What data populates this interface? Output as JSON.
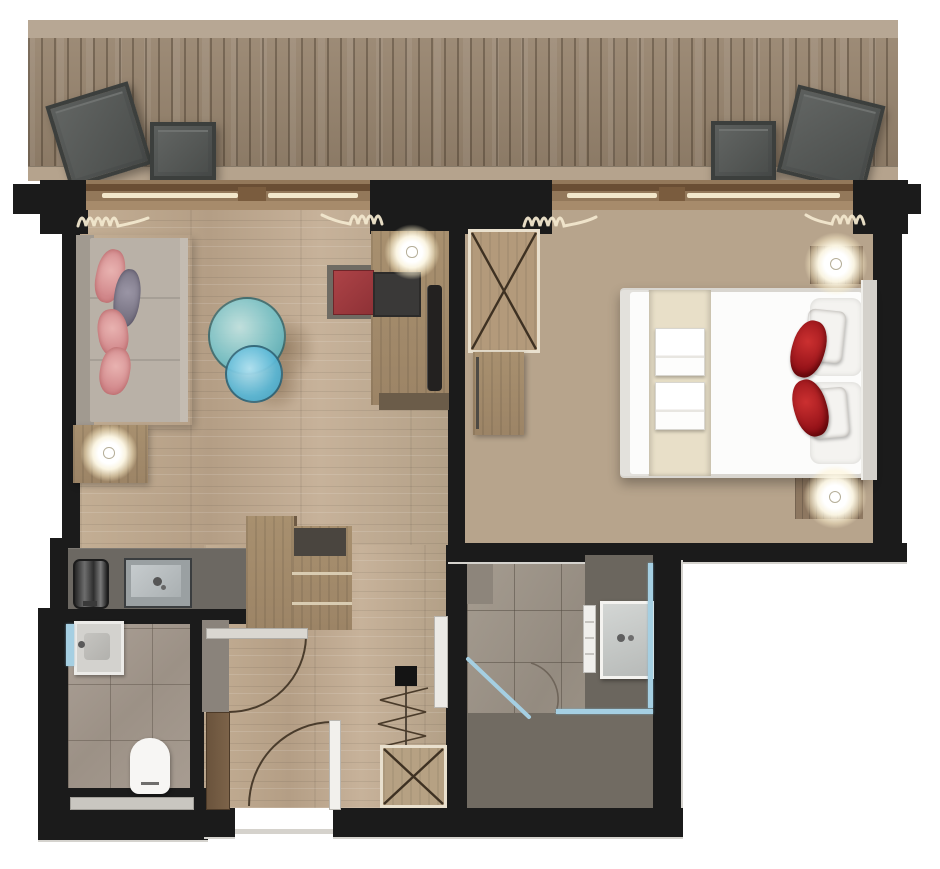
{
  "title": "Hotel suite floor plan",
  "canvas": {
    "width": 940,
    "height": 869
  },
  "palette": {
    "wall": "#1b1b1b",
    "wood_floor": "#c0ab92",
    "bedroom_floor": "#b7a48c",
    "balcony_deck": "#97846e",
    "wc_tile": "#a69b90",
    "bath_tile": "#9e958a",
    "shower_tile": "#716b62",
    "glass_blue": "#a5cfe2",
    "accent_red": "#b11d24",
    "pillow_pink": "#dfa0a0",
    "table_teal": "#79c3c8",
    "counter_gray": "#6c6862",
    "bed_white": "#fcfcfb",
    "runner_beige": "#e8dfc8",
    "glazing_cream": "#f2e7cb"
  },
  "rooms": [
    {
      "name": "balcony"
    },
    {
      "name": "living-room"
    },
    {
      "name": "bedroom"
    },
    {
      "name": "kitchenette"
    },
    {
      "name": "wc"
    },
    {
      "name": "hallway"
    },
    {
      "name": "bathroom"
    }
  ],
  "furniture": {
    "balcony": [
      "lounge-chair-tilted",
      "lounge-chair",
      "lounge-chair",
      "lounge-chair-tilted"
    ],
    "living_room": [
      "sofa",
      "pink-pillow",
      "purple-pillow",
      "pink-pillow",
      "pink-pillow",
      "round-glass-table-large",
      "round-glass-table-small",
      "side-table",
      "ceiling-lamp",
      "ceiling-lamp",
      "desk",
      "red-seat",
      "dark-seat",
      "tv-panel",
      "wall-tv"
    ],
    "bedroom": [
      "double-bed",
      "duvet",
      "bed-runner",
      "towel-set",
      "towel-set",
      "white-pillow",
      "white-pillow",
      "gray-pillow",
      "gray-pillow",
      "red-pillow",
      "red-pillow",
      "headboard",
      "wardrobe-x",
      "dresser",
      "nightstand",
      "nightstand",
      "ceiling-lamp",
      "ceiling-lamp"
    ],
    "kitchenette": [
      "countertop",
      "inset-sink",
      "coffee-machine",
      "tall-cabinet",
      "minibar-shelves"
    ],
    "wc": [
      "washbasin",
      "mirror",
      "toilet",
      "bench"
    ],
    "hallway": [
      "wardrobe-x",
      "entry-door",
      "wc-door",
      "utility-box",
      "door-threshold"
    ],
    "bathroom": [
      "vanity-counter",
      "washbasin",
      "mirror",
      "towel-radiator",
      "glass-shower-screen",
      "glass-door",
      "walk-in-shower"
    ]
  },
  "symbols": {
    "radiator_squiggles": 4,
    "door_swing_arcs": 3,
    "wardrobe_x_marks": 2,
    "ceiling_lamps": 4
  }
}
